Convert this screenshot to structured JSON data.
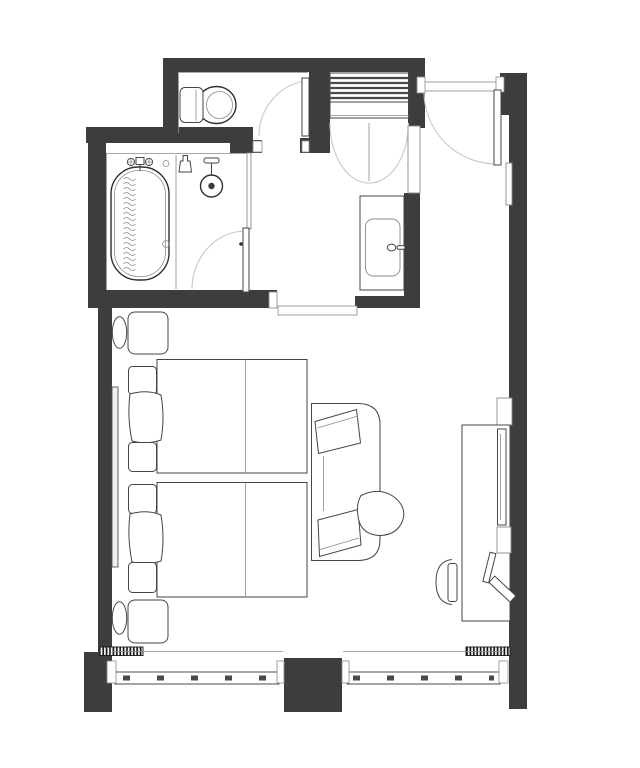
{
  "page": {
    "title": "Hotel room floor plan",
    "background": "#ffffff"
  },
  "plan": {
    "kind": "architectural floor plan, top-down, monochrome line drawing, no text labels",
    "colors": {
      "wall": "#3d3d3d",
      "line": "#454545",
      "lightline": "#8a8a8a",
      "swing": "#c9c9c9",
      "bg": "#ffffff"
    },
    "rooms": {
      "bathroom": {
        "label": "Bathroom with bathtub and shower area"
      },
      "toilet": {
        "label": "Toilet room"
      },
      "closet": {
        "label": "Closet with slatted shelves and double doors"
      },
      "entry": {
        "label": "Entry with inward-swinging door"
      },
      "vanity": {
        "label": "Vanity alcove with rectangular sink"
      },
      "bedroom": {
        "label": "Bedroom with two beds, sofa, side table and TV console"
      }
    },
    "fixtures": {
      "bathtub": {
        "label": "Bathtub with ribbed hose texture"
      },
      "tub_faucet": {
        "label": "Tub filler valves and spout"
      },
      "hand_shower": {
        "label": "Hand shower on rail"
      },
      "rain_shower": {
        "label": "Overhead rain shower head"
      },
      "shower_screen": {
        "label": "Glass divider between tub and shower"
      },
      "toilet": {
        "label": "Toilet with tank"
      },
      "toilet_door": {
        "label": "Toilet room door with swing arc"
      },
      "bathroom_door": {
        "label": "Bathroom door with swing arc"
      },
      "closet_shelves": {
        "label": "Slatted closet shelf stack"
      },
      "closet_doors": {
        "label": "Closet double doors with swing arcs"
      },
      "entry_door": {
        "label": "Entry door with swing arc"
      },
      "vanity_counter": {
        "label": "Vanity counter"
      },
      "vanity_sink": {
        "label": "Rectangular vanity basin with faucet"
      },
      "tall_cabinet": {
        "label": "Tall cabinet beside vanity"
      },
      "wall_panel": {
        "label": "Panel on entry corridor wall"
      },
      "bed_1": {
        "label": "Bed 1 with folded runner"
      },
      "bed_2": {
        "label": "Bed 2 with folded runner"
      },
      "pillows": {
        "label": "Stacked pillows"
      },
      "nightstand_1": {
        "label": "Nightstand 1"
      },
      "nightstand_2": {
        "label": "Nightstand 2"
      },
      "bedside_oval_1": {
        "label": "Bedside stool 1"
      },
      "bedside_oval_2": {
        "label": "Bedside stool 2"
      },
      "headboard": {
        "label": "Headboard rail panel"
      },
      "sofa": {
        "label": "Sofa with two cushions"
      },
      "side_table": {
        "label": "Pick-shaped side table"
      },
      "desk": {
        "label": "Desk / TV console"
      },
      "tv": {
        "label": "Wall-mounted TV panel"
      },
      "desk_chair": {
        "label": "Desk chair"
      },
      "desk_items": {
        "label": "Angled desk accessories"
      },
      "fan_coil_left": {
        "label": "Hatched floor unit left"
      },
      "fan_coil_right": {
        "label": "Hatched floor unit right"
      },
      "window_left": {
        "label": "Window band left section"
      },
      "window_right": {
        "label": "Window band right section"
      },
      "window_pier": {
        "label": "Structural pier between windows"
      },
      "threshold": {
        "label": "Threshold at bedroom opening"
      }
    }
  }
}
